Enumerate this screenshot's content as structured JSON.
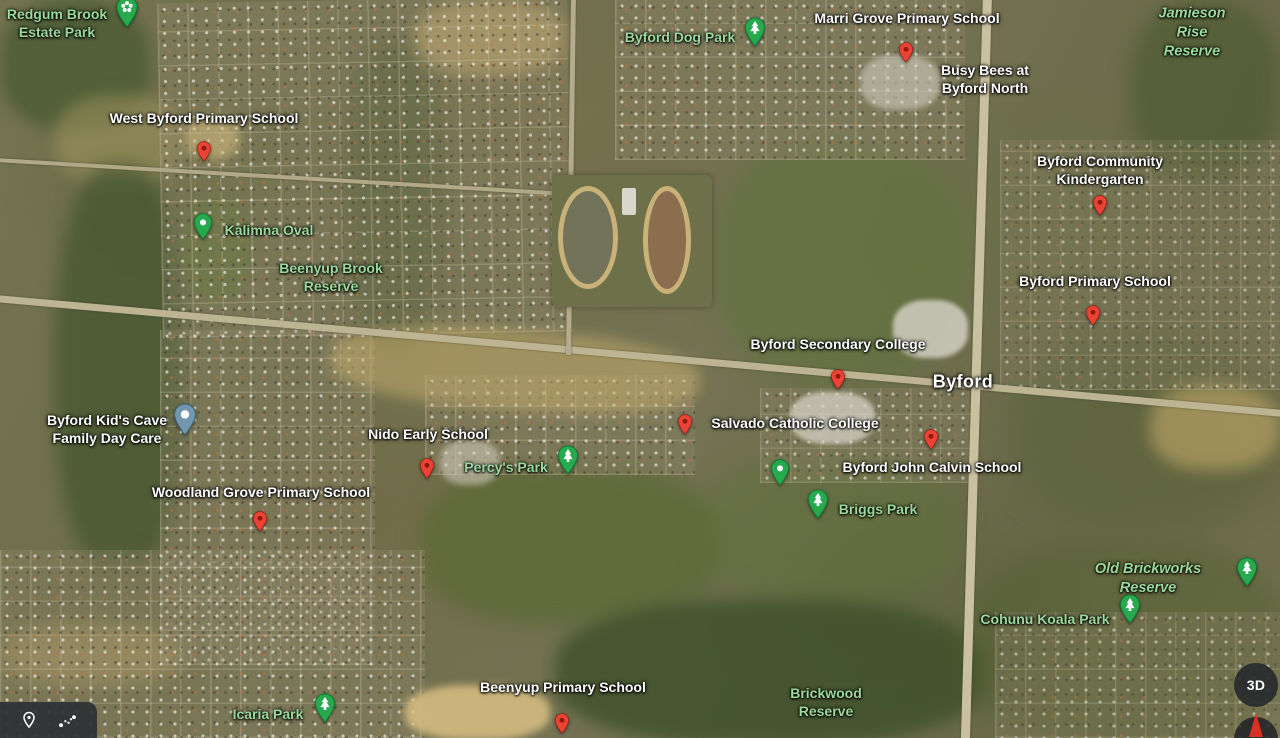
{
  "app": {
    "name": "Google Maps satellite view - Byford WA"
  },
  "map": {
    "view_mode": "satellite",
    "colors": {
      "label-white": "#ffffff",
      "label-park-green": "#9bd89b",
      "pin-red": "#ea4335",
      "pin-red-dark": "#8e1b0d",
      "pin-green": "#27a94e",
      "pin-green-dark": "#0b7b36",
      "pin-blue": "#7097ae",
      "pin-blue-dark": "#3e6277",
      "compass-needle-red": "#d93025",
      "control-bg-dark": "#36393c"
    },
    "labels": [
      {
        "text": "Redgum Brook\nEstate Park",
        "x": 57,
        "y": 23,
        "style": "park"
      },
      {
        "text": "West Byford Primary School",
        "x": 204,
        "y": 118,
        "style": "poi"
      },
      {
        "text": "Kalimna Oval",
        "x": 269,
        "y": 230,
        "style": "park"
      },
      {
        "text": "Beenyup Brook\nReserve",
        "x": 331,
        "y": 277,
        "style": "park"
      },
      {
        "text": "Byford Dog Park",
        "x": 680,
        "y": 37,
        "style": "park"
      },
      {
        "text": "Marri Grove Primary School",
        "x": 907,
        "y": 18,
        "style": "poi"
      },
      {
        "text": "Busy Bees at\nByford North",
        "x": 985,
        "y": 79,
        "style": "poi"
      },
      {
        "text": "Jamieson Rise Reserve",
        "x": 1192,
        "y": 33,
        "style": "reserve"
      },
      {
        "text": "Byford Community Kindergarten",
        "x": 1100,
        "y": 170,
        "style": "poi"
      },
      {
        "text": "Byford Primary School",
        "x": 1095,
        "y": 281,
        "style": "poi"
      },
      {
        "text": "Byford Secondary College",
        "x": 838,
        "y": 344,
        "style": "poi"
      },
      {
        "text": "Byford",
        "x": 963,
        "y": 382,
        "style": "town"
      },
      {
        "text": "Salvado Catholic College",
        "x": 795,
        "y": 423,
        "style": "poi"
      },
      {
        "text": "Byford John Calvin School",
        "x": 932,
        "y": 467,
        "style": "poi"
      },
      {
        "text": "Byford Kid's Cave\nFamily Day Care",
        "x": 107,
        "y": 429,
        "style": "poi"
      },
      {
        "text": "Nido Early School",
        "x": 428,
        "y": 434,
        "style": "poi"
      },
      {
        "text": "Percy's Park",
        "x": 506,
        "y": 467,
        "style": "park"
      },
      {
        "text": "Woodland Grove Primary School",
        "x": 261,
        "y": 492,
        "style": "poi"
      },
      {
        "text": "Briggs Park",
        "x": 878,
        "y": 509,
        "style": "park"
      },
      {
        "text": "Old Brickworks Reserve",
        "x": 1148,
        "y": 579,
        "style": "reserve"
      },
      {
        "text": "Cohunu Koala Park",
        "x": 1045,
        "y": 619,
        "style": "park"
      },
      {
        "text": "Icaria Park",
        "x": 268,
        "y": 714,
        "style": "park"
      },
      {
        "text": "Beenyup Primary School",
        "x": 563,
        "y": 687,
        "style": "poi"
      },
      {
        "text": "Brickwood\nReserve",
        "x": 826,
        "y": 702,
        "style": "park"
      }
    ],
    "pins": [
      {
        "kind": "green-flower",
        "x": 127,
        "y": 33,
        "for": "Redgum Brook Estate Park"
      },
      {
        "kind": "red",
        "x": 204,
        "y": 167,
        "for": "West Byford Primary School"
      },
      {
        "kind": "green-dot",
        "x": 203,
        "y": 245,
        "for": "Kalimna Oval"
      },
      {
        "kind": "green-tree",
        "x": 755,
        "y": 52,
        "for": "Byford Dog Park"
      },
      {
        "kind": "red",
        "x": 906,
        "y": 68,
        "for": "Marri Grove Primary School"
      },
      {
        "kind": "red",
        "x": 1100,
        "y": 221,
        "for": "Byford Community Kindergarten"
      },
      {
        "kind": "red",
        "x": 1093,
        "y": 331,
        "for": "Byford Primary School"
      },
      {
        "kind": "red",
        "x": 838,
        "y": 395,
        "for": "Byford Secondary College"
      },
      {
        "kind": "red",
        "x": 685,
        "y": 440,
        "for": "Salvado Catholic College"
      },
      {
        "kind": "red",
        "x": 931,
        "y": 455,
        "for": "Byford John Calvin School"
      },
      {
        "kind": "blue-dot",
        "x": 185,
        "y": 441,
        "for": "Byford Kid's Cave Family Day Care"
      },
      {
        "kind": "red",
        "x": 427,
        "y": 484,
        "for": "Nido Early School"
      },
      {
        "kind": "green-tree",
        "x": 568,
        "y": 480,
        "for": "Percy's Park"
      },
      {
        "kind": "green-dot",
        "x": 780,
        "y": 491,
        "for": "park"
      },
      {
        "kind": "green-tree",
        "x": 818,
        "y": 524,
        "for": "Briggs Park"
      },
      {
        "kind": "red",
        "x": 260,
        "y": 537,
        "for": "Woodland Grove Primary School"
      },
      {
        "kind": "green-tree",
        "x": 1247,
        "y": 592,
        "for": "Old Brickworks Reserve"
      },
      {
        "kind": "green-tree",
        "x": 1130,
        "y": 629,
        "for": "Cohunu Koala Park"
      },
      {
        "kind": "green-tree",
        "x": 325,
        "y": 728,
        "for": "Icaria Park"
      },
      {
        "kind": "red",
        "x": 562,
        "y": 739,
        "for": "Beenyup Primary School"
      }
    ]
  },
  "controls": {
    "three_d_label": "3D",
    "tools": {
      "location_tool": "location-pin",
      "measure_tool": "measure-distance"
    }
  }
}
